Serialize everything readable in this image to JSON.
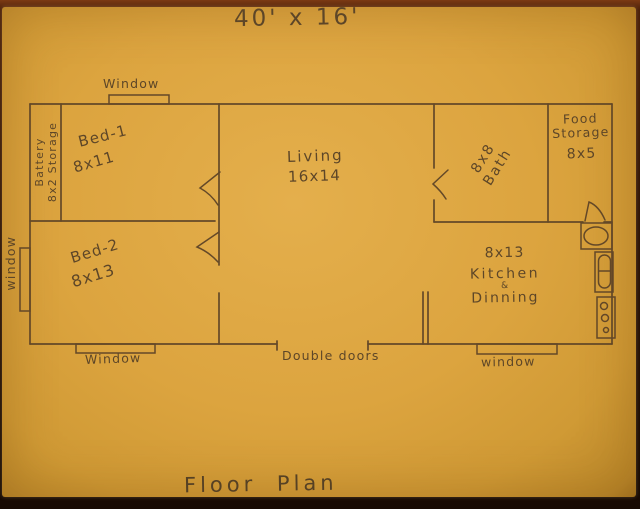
{
  "title": "40' x 16'",
  "caption": "Floor Plan",
  "colors": {
    "paper": "#dca43f",
    "pencil": "#5a4126",
    "backdrop": "#2e1406"
  },
  "rooms": {
    "bed1": {
      "name": "Bed-1",
      "dims": "8x11"
    },
    "bed2": {
      "name": "Bed-2",
      "dims": "8x13"
    },
    "living": {
      "name": "Living",
      "dims": "16x14"
    },
    "bath": {
      "name": "Bath",
      "dims": "8x8"
    },
    "battery_storage": {
      "name": "Battery",
      "dims_and_name": "8x2 Storage"
    },
    "food_storage": {
      "name_line1": "Food",
      "name_line2": "Storage",
      "dims": "8x5"
    },
    "kitchen_dining": {
      "dims": "8x13",
      "name_line1": "Kitchen",
      "conjunction": "&",
      "name_line2": "Dinning"
    }
  },
  "openings": {
    "window_top": "Window",
    "window_left": "window",
    "window_bottom_left": "Window",
    "window_bottom_right": "window",
    "double_doors": "Double doors"
  },
  "fixtures": [
    "counter",
    "double-sink",
    "stove-burners"
  ]
}
